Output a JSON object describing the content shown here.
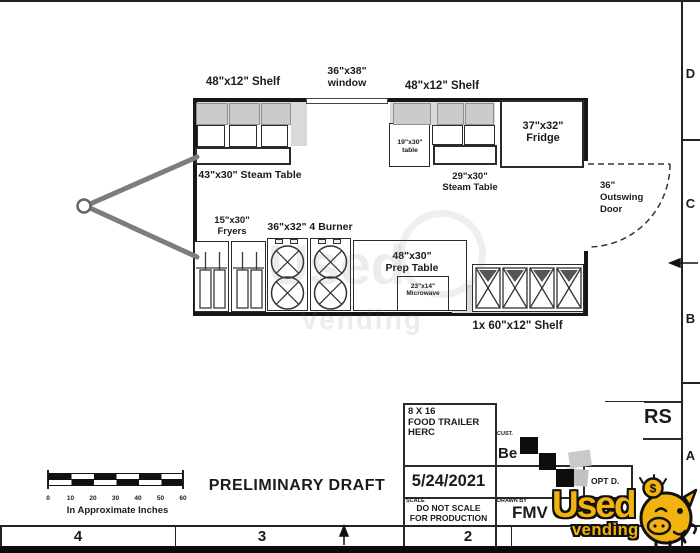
{
  "drawing": {
    "labels": {
      "shelf_left": "48\"x12\" Shelf",
      "window_size": "36\"x38\"",
      "window_word": "window",
      "shelf_right": "48\"x12\" Shelf",
      "fridge_size": "37\"x32\"",
      "fridge_word": "Fridge",
      "steam_left": "43\"x30\" Steam Table",
      "small_table_size": "19\"x30\"",
      "small_table_word": "table",
      "steam_right_size": "29\"x30\"",
      "steam_right_word": "Steam Table",
      "door_size": "36\"",
      "door_line2": "Outswing",
      "door_line3": "Door",
      "fryers_size": "15\"x30\"",
      "fryers_word": "Fryers",
      "burner": "36\"x32\" 4 Burner",
      "prep_size": "48\"x30\"",
      "prep_word": "Prep Table",
      "microwave_size": "23\"x14\"",
      "microwave_word": "Microwave",
      "shelf_bottom": "1x 60\"x12\" Shelf"
    }
  },
  "scalebar": {
    "ticks": [
      "0",
      "10",
      "20",
      "30",
      "40",
      "50",
      "60"
    ],
    "caption": "In Approximate Inches"
  },
  "draft_text": "PRELIMINARY DRAFT",
  "titleblock": {
    "project_line1": "8 X 16",
    "project_line2": "FOOD TRAILER",
    "project_line3": "HERC",
    "customer_label": "CUST.",
    "customer_value": "Be",
    "date": "5/24/2021",
    "scale_label": "SCALE",
    "scale_note_line1": "DO NOT SCALE",
    "scale_note_line2": "FOR PRODUCTION",
    "drawn_by_label": "DRAWN BY",
    "drawn_by_value": "FMV",
    "opt": "OPT D.",
    "partial_text": "RS"
  },
  "border": {
    "rows": [
      "D",
      "C",
      "B",
      "A"
    ],
    "cols": [
      "4",
      "3",
      "2"
    ]
  },
  "logo": {
    "line1": "Used",
    "line2": "vending",
    "coin_symbol": "$",
    "colors": {
      "yellow": "#F3B30E",
      "outline": "#111111"
    }
  },
  "watermark": {
    "line1": "Used",
    "line2": "Vending"
  }
}
